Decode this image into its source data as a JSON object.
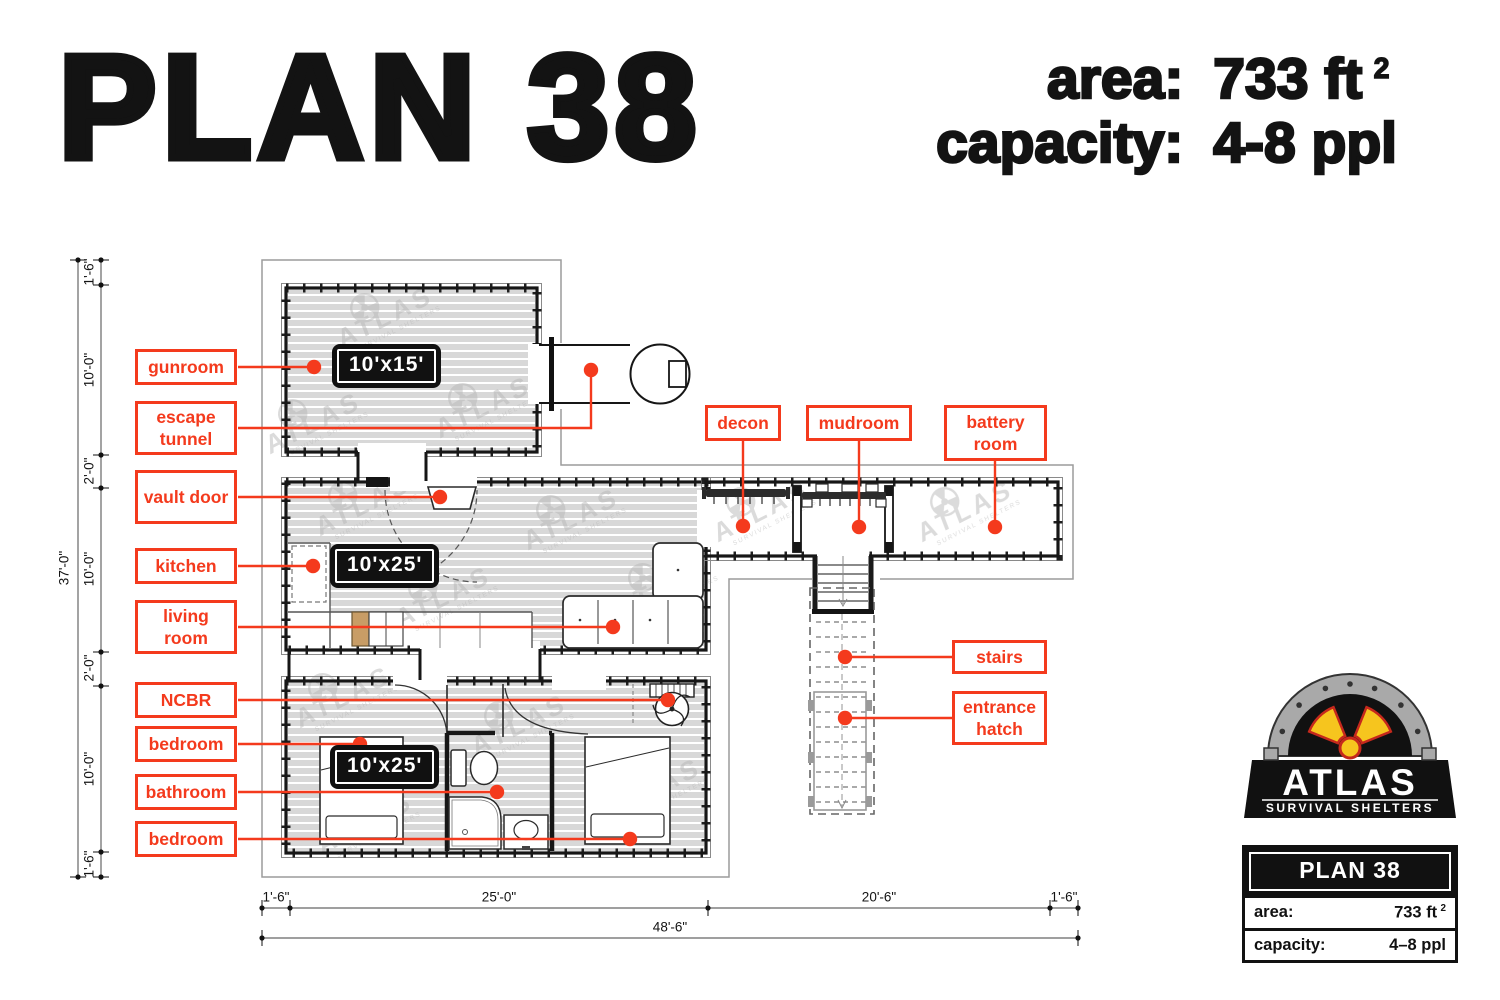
{
  "header": {
    "title": "PLAN 38",
    "area_label": "area:",
    "area_value": "733 ft",
    "area_sup": "2",
    "capacity_label": "capacity:",
    "capacity_value": "4-8 ppl"
  },
  "plan": {
    "labels": {
      "gunroom": "gunroom",
      "escape_tunnel": "escape tunnel",
      "vault_door": "vault door",
      "kitchen": "kitchen",
      "living_room": "living room",
      "ncbr": "NCBR",
      "bedroom_1": "bedroom",
      "bathroom": "bathroom",
      "bedroom_2": "bedroom",
      "decon": "decon",
      "mudroom": "mudroom",
      "battery_room": "battery room",
      "stairs": "stairs",
      "entrance_hatch": "entrance hatch"
    },
    "size_badges": {
      "gunroom": "10'x15'",
      "living": "10'x25'",
      "bedroom": "10'x25'"
    },
    "dimensions": {
      "left_total": "37'-0\"",
      "left_segments": [
        "1'-6\"",
        "10'-0\"",
        "2'-0\"",
        "10'-0\"",
        "2'-0\"",
        "10'-0\"",
        "1'-6\""
      ],
      "bottom_segments": [
        "1'-6\"",
        "25'-0\"",
        "20'-6\"",
        "1'-6\""
      ],
      "bottom_total": "48'-6\""
    },
    "watermark_text": "ATLAS"
  },
  "logo": {
    "brand": "ATLAS",
    "tagline": "SURVIVAL SHELTERS",
    "plan": "PLAN 38",
    "area_label": "area:",
    "area_value": "733 ft",
    "area_sup": "2",
    "capacity_label": "capacity:",
    "capacity_value": "4–8 ppl"
  },
  "colors": {
    "accent": "#f43a1d",
    "wall": "#1a1a1a",
    "boundary": "#9c9c9c",
    "floor": "#d8d8d8",
    "watermark": "#b7b7b7",
    "logo_yellow": "#f6c51e",
    "logo_red": "#c5281c",
    "logo_gray": "#a9a9a9"
  }
}
